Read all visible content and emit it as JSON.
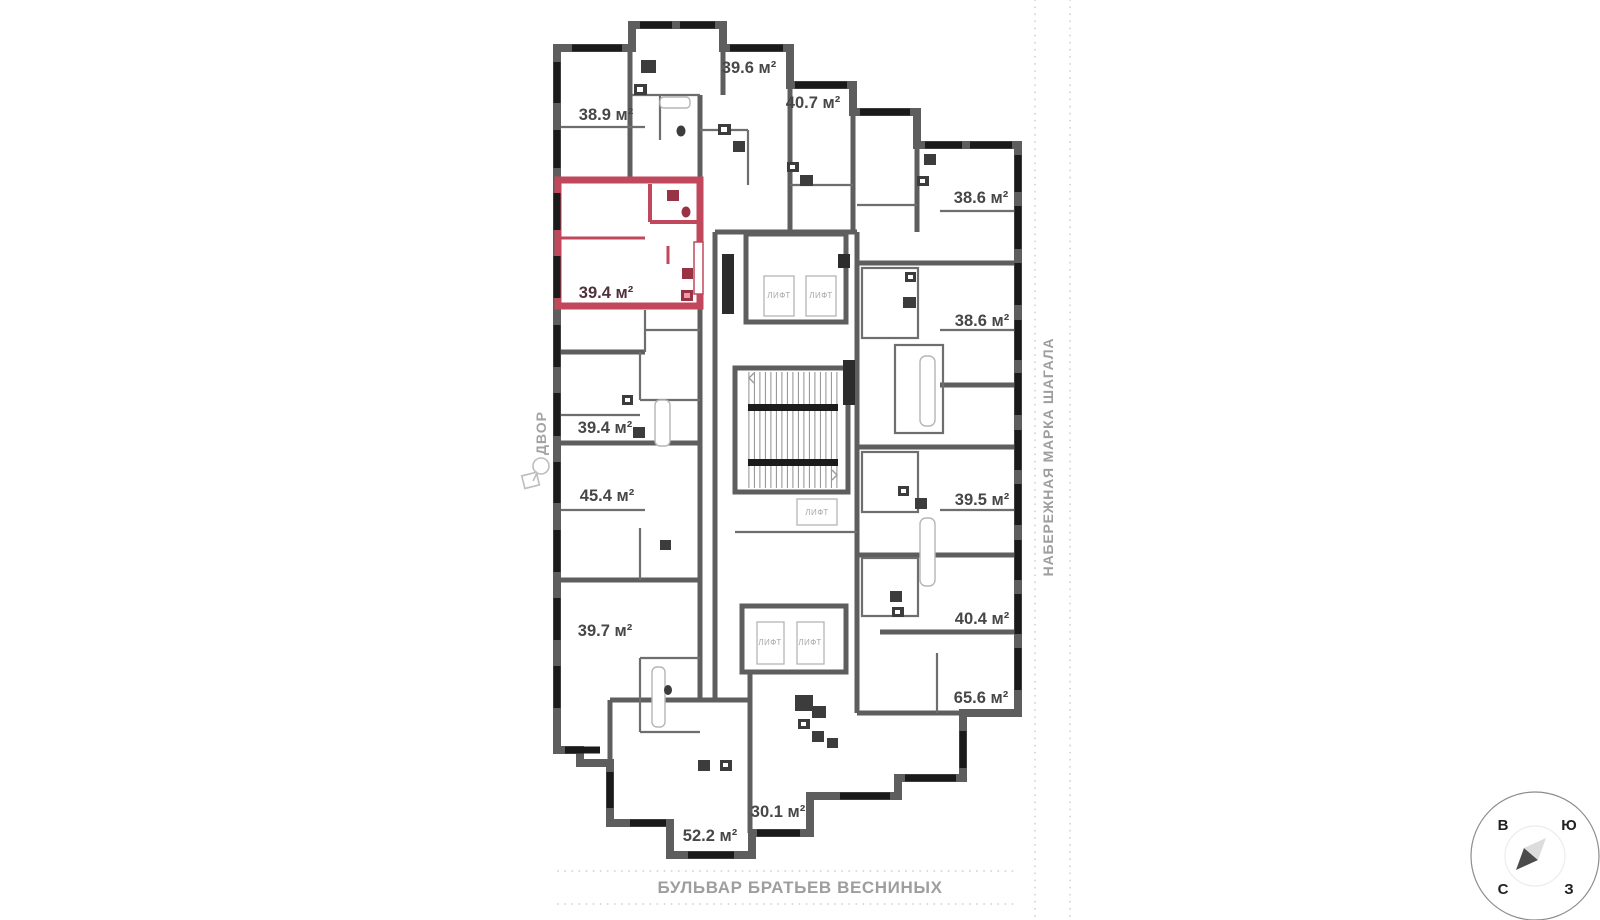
{
  "plan": {
    "apartments": [
      {
        "id": "38-9",
        "area": "38.9 м²",
        "highlighted": false
      },
      {
        "id": "39-6",
        "area": "39.6 м²",
        "highlighted": false
      },
      {
        "id": "40-7",
        "area": "40.7 м²",
        "highlighted": false
      },
      {
        "id": "38-6-a",
        "area": "38.6 м²",
        "highlighted": false
      },
      {
        "id": "39-4-selected",
        "area": "39.4 м²",
        "highlighted": true
      },
      {
        "id": "38-6-b",
        "area": "38.6 м²",
        "highlighted": false
      },
      {
        "id": "39-4",
        "area": "39.4 м²",
        "highlighted": false
      },
      {
        "id": "45-4",
        "area": "45.4 м²",
        "highlighted": false
      },
      {
        "id": "39-5",
        "area": "39.5 м²",
        "highlighted": false
      },
      {
        "id": "39-7",
        "area": "39.7 м²",
        "highlighted": false
      },
      {
        "id": "40-4",
        "area": "40.4 м²",
        "highlighted": false
      },
      {
        "id": "65-6",
        "area": "65.6 м²",
        "highlighted": false
      },
      {
        "id": "30-1",
        "area": "30.1 м²",
        "highlighted": false
      },
      {
        "id": "52-2",
        "area": "52.2 м²",
        "highlighted": false
      }
    ],
    "elevator_label": "ЛИФТ",
    "colors": {
      "wall": "#5e5e5e",
      "window": "#1a1a1a",
      "highlight_fill": "#f09aa7",
      "highlight_border": "#c1485c",
      "highlight_fixture": "#993245",
      "area_label": "#474747",
      "street_label": "#9e9e9e"
    }
  },
  "streets": {
    "bottom": "БУЛЬВАР БРАТЬЕВ ВЕСНИНЫХ",
    "right": "НАБЕРЕЖНАЯ МАРКА ШАГАЛА",
    "courtyard": "ДВОР"
  },
  "compass": {
    "east": "В",
    "south": "Ю",
    "north": "С",
    "west": "З"
  }
}
